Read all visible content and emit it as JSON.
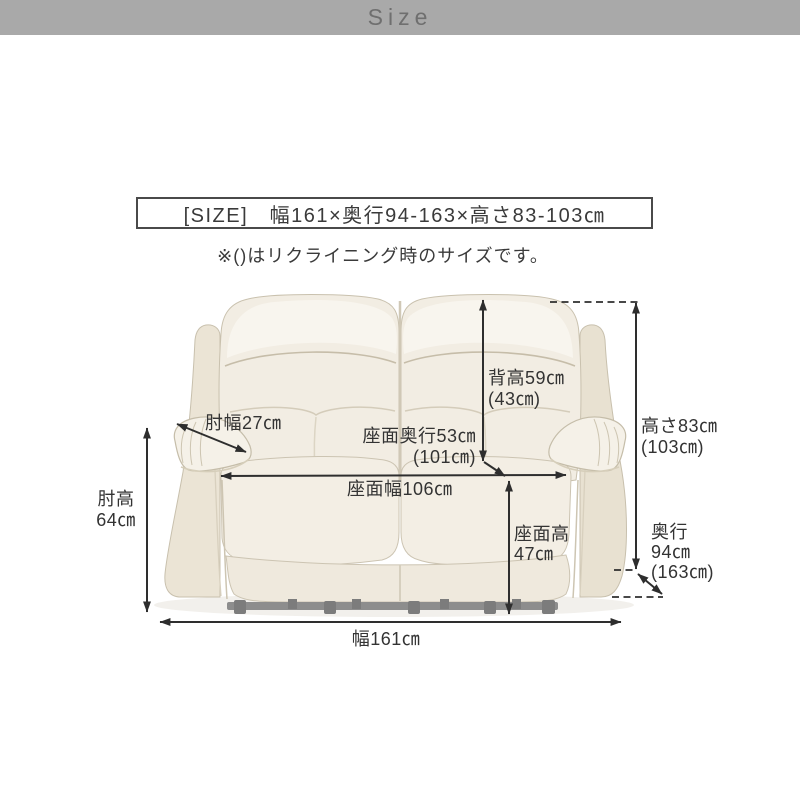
{
  "header": {
    "title": "Size"
  },
  "size_box": {
    "text": "[SIZE]　幅161×奥行94-163×高さ83-103㎝"
  },
  "note": "※()はリクライニング時のサイズです。",
  "figure": {
    "labels": {
      "back_height": {
        "line1": "背高59㎝",
        "line2": "(43㎝)"
      },
      "overall_height": {
        "line1": "高さ83㎝",
        "line2": "(103㎝)"
      },
      "armrest_width": {
        "line1": "肘幅27㎝"
      },
      "armrest_height": {
        "line1": "肘高",
        "line2": "64㎝"
      },
      "seat_depth": {
        "line1": "座面奥行53㎝",
        "line2": "(101㎝)"
      },
      "seat_width": {
        "line1": "座面幅106㎝"
      },
      "seat_height": {
        "line1": "座面高",
        "line2": "47㎝"
      },
      "depth": {
        "line1": "奥行",
        "line2": "94㎝",
        "line3": "(163㎝)"
      },
      "overall_width": {
        "line1": "幅161㎝"
      }
    },
    "colors": {
      "header_background": "#a9a9a9",
      "header_text": "#6f6f6f",
      "arrow": "#2e2e2e",
      "label_text": "#333333",
      "box_border": "#4a4a4a",
      "sofa_body": "#f2ede3",
      "sofa_shade": "#e8e1d1",
      "metal_bar": "#8d8d8d"
    }
  }
}
